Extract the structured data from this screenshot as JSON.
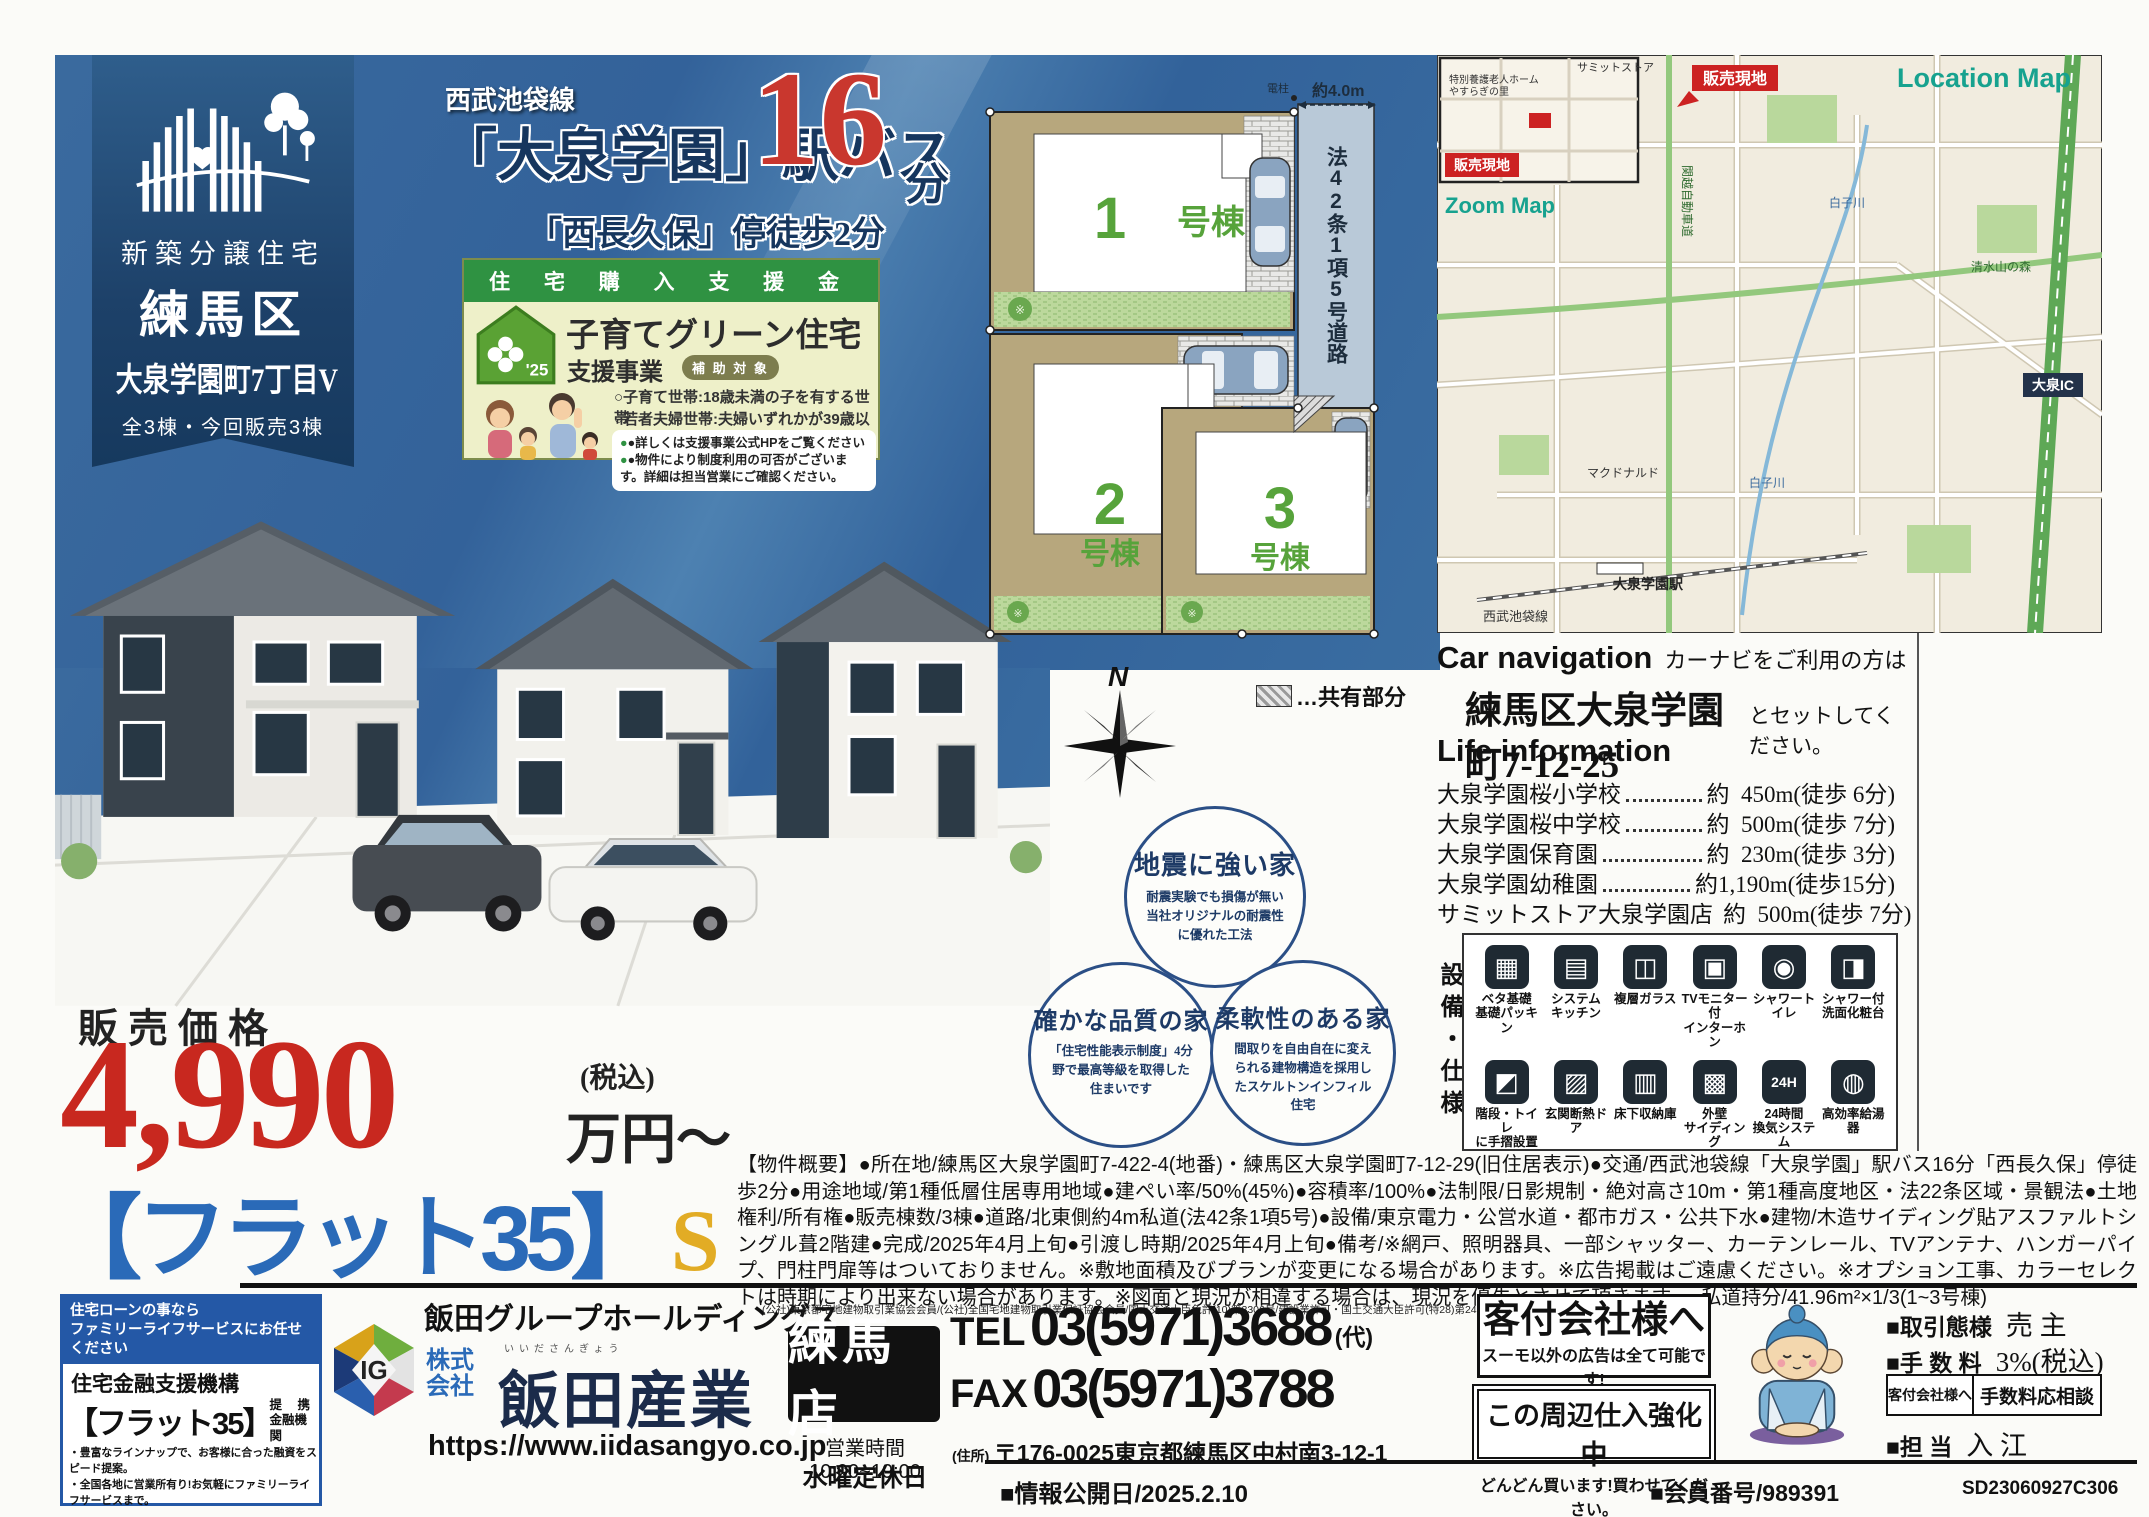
{
  "banner": {
    "category": "新築分譲住宅",
    "ward": "練馬区",
    "name": "大泉学園町7丁目V",
    "units": "全3棟・今回販売3棟"
  },
  "access": {
    "line": "西武池袋線",
    "station": "「大泉学園」駅バス",
    "minutes": "16",
    "minutes_unit": "分",
    "bus_stop": "「西長久保」停徒歩2分"
  },
  "subsidy": {
    "header": "住 宅 購 入 支 援 金",
    "title": "子育てグリーン住宅",
    "subtitle": "支援事業",
    "year_badge": "'25",
    "target_label": "補 助 対 象",
    "targets": [
      "○子育て世帯:18歳未満の子を有する世帯",
      "○若者夫婦世帯:夫婦いずれかが39歳以下世帯"
    ],
    "notes": [
      "●詳しくは支援事業公式HPをご覧ください",
      "●物件により制度利用の可否がございます。詳細は担当営業にご確認ください。"
    ]
  },
  "site_plan": {
    "lots": [
      {
        "num": "1",
        "suffix": "号棟"
      },
      {
        "num": "2",
        "suffix": "号棟"
      },
      {
        "num": "3",
        "suffix": "号棟"
      }
    ],
    "road_label": "法42条1項5号道路",
    "road_width": "約4.0m",
    "pole_label": "電柱",
    "legend": "…共有部分",
    "north": "N"
  },
  "map": {
    "title": "Location Map",
    "zoom_label": "Zoom Map",
    "site_label": "販売現地",
    "labels": {
      "ic": "大泉IC",
      "river": "白子川",
      "park": "清水山の森",
      "store": "サミットストア",
      "mcd": "マクドナルド",
      "rail": "西武池袋線",
      "station": "大泉学園駅",
      "home": "特別養護老人ホーム",
      "home2": "やすらぎの里",
      "kanetsu": "関越自動車道"
    }
  },
  "car_navigation": {
    "title": "Car navigation",
    "lead": "カーナビをご利用の方は",
    "address": "練馬区大泉学園町7-12-25",
    "suffix": "とセットしてください。"
  },
  "life_information": {
    "title": "Life information",
    "items": [
      {
        "name": "大泉学園桜小学校",
        "value": "約  450m(徒歩 6分)"
      },
      {
        "name": "大泉学園桜中学校",
        "value": "約  500m(徒歩 7分)"
      },
      {
        "name": "大泉学園保育園",
        "value": "約  230m(徒歩 3分)"
      },
      {
        "name": "大泉学園幼稚園",
        "value": "約1,190m(徒歩15分)"
      },
      {
        "name": "サミットストア大泉学園店",
        "value": "約  500m(徒歩 7分)"
      }
    ]
  },
  "features": [
    {
      "title": "地震に強い家",
      "desc": "耐震実験でも損傷が無い当社オリジナルの耐震性に優れた工法"
    },
    {
      "title": "確かな品質の家",
      "desc": "「住宅性能表示制度」4分野で最高等級を取得した住まいです"
    },
    {
      "title": "柔軟性のある家",
      "desc": "間取りを自由自在に変えられる建物構造を採用したスケルトンインフィル住宅"
    }
  ],
  "equipment": {
    "side_label": "設備・仕様",
    "items": [
      {
        "glyph": "▦",
        "line1": "ベタ基礎",
        "line2": "基礎パッキン"
      },
      {
        "glyph": "▤",
        "line1": "システム",
        "line2": "キッチン"
      },
      {
        "glyph": "◫",
        "line1": "複層ガラス",
        "line2": ""
      },
      {
        "glyph": "▣",
        "line1": "TVモニター付",
        "line2": "インターホン"
      },
      {
        "glyph": "◉",
        "line1": "シャワートイレ",
        "line2": ""
      },
      {
        "glyph": "◨",
        "line1": "シャワー付",
        "line2": "洗面化粧台"
      },
      {
        "glyph": "◩",
        "line1": "階段・トイレ",
        "line2": "に手摺設置"
      },
      {
        "glyph": "▨",
        "line1": "玄関断熱ドア",
        "line2": ""
      },
      {
        "glyph": "▥",
        "line1": "床下収納庫",
        "line2": ""
      },
      {
        "glyph": "▩",
        "line1": "外壁",
        "line2": "サイディング"
      },
      {
        "glyph": "24H",
        "line1": "24時間",
        "line2": "換気システム"
      },
      {
        "glyph": "◍",
        "line1": "高効率給湯器",
        "line2": ""
      }
    ]
  },
  "price": {
    "label": "販売価格",
    "amount": "4,990",
    "tax_note": "(税込)",
    "unit": "万円〜"
  },
  "loan": {
    "bracket": "【フラット35】",
    "s": "S"
  },
  "outline": {
    "text": "【物件概要】●所在地/練馬区大泉学園町7-422-4(地番)・練馬区大泉学園町7-12-29(旧住居表示)●交通/西武池袋線「大泉学園」駅バス16分「西長久保」停徒歩2分●用途地域/第1種低層住居専用地域●建ぺい率/50%(45%)●容積率/100%●法制限/日影規制・絶対高さ10m・第1種高度地区・法22条区域・景観法●土地権利/所有権●販売棟数/3棟●道路/北東側約4m私道(法42条1項5号)●設備/東京電力・公営水道・都市ガス・公共下水●建物/木造サイディング貼アスファルトシングル葺2階建●完成/2025年4月上旬●引渡し時期/2025年4月上旬●備考/※網戸、照明器具、一部シャッター、カーテンレール、TVアンテナ、ハンガーパイプ、門柱門扉等はついておりません。※敷地面積及びプランが変更になる場合があります。※広告掲載はご遠慮ください。※オプション工事、カラーセレクトは時期により出来ない場合があります。※図面と現況が相違する場合は、現況を優先とさせて頂きます。●私道持分/41.96m²×1/3(1~3号棟)"
  },
  "flat35_box": {
    "header1": "住宅ローンの事なら",
    "header2": "ファミリーライフサービスにお任せください",
    "org": "住宅金融支援機構",
    "product": "【フラット35】",
    "tie1": "提 携",
    "tie2": "金融機関",
    "bullet1": "・豊富なラインナップで、お客様に合った融資をスピード提案。",
    "bullet2": "・全国各地に営業所有り!お気軽にファミリーライフサービスまで。",
    "phone": "0120-068-035",
    "url": "http://www.familyls.jp"
  },
  "company": {
    "group": "飯田グループホールディングス",
    "assoc": "(公社)東京都宅地建物取引業協会会員/(公社)全国宅地建物取引業保証協会会員/国土交通大臣免許(10)第3306号/建設業許可・国土交通大臣許可(特28)第24082号",
    "corp_prefix1": "株式",
    "corp_prefix2": "会社",
    "kana": "いいださんぎょう",
    "corp_name": "飯田産業",
    "url": "https://www.iidasangyo.co.jp",
    "branch": "練馬店",
    "hours": "営業時間 10:00~19:00",
    "closed": "水曜定休日",
    "tel_label": "TEL",
    "tel": "03(5971)3688",
    "tel_suffix": "(代)",
    "fax_label": "FAX",
    "fax": "03(5971)3788",
    "addr_label": "(住所)",
    "address": "〒176-0025東京都練馬区中村南3-12-1"
  },
  "agent": {
    "title": "客付会社様へ",
    "line": "スーモ以外の広告は全て可能です!",
    "box2a": "この周辺仕入強化中",
    "box2b": "どんどん買います!買わせてください。"
  },
  "deal": {
    "row1_label": "■取引態様",
    "row1_value": "売 主",
    "row2_label": "■手 数 料",
    "row2_value": "3%(税込)",
    "cell_left": "客付会社様へ",
    "cell_right": "手数料応相談",
    "row3_label": "■担 当",
    "row3_value": "入 江"
  },
  "meta": {
    "published": "■情報公開日/2025.2.10",
    "member": "■会員番号/989391",
    "code": "SD23060927C306"
  }
}
